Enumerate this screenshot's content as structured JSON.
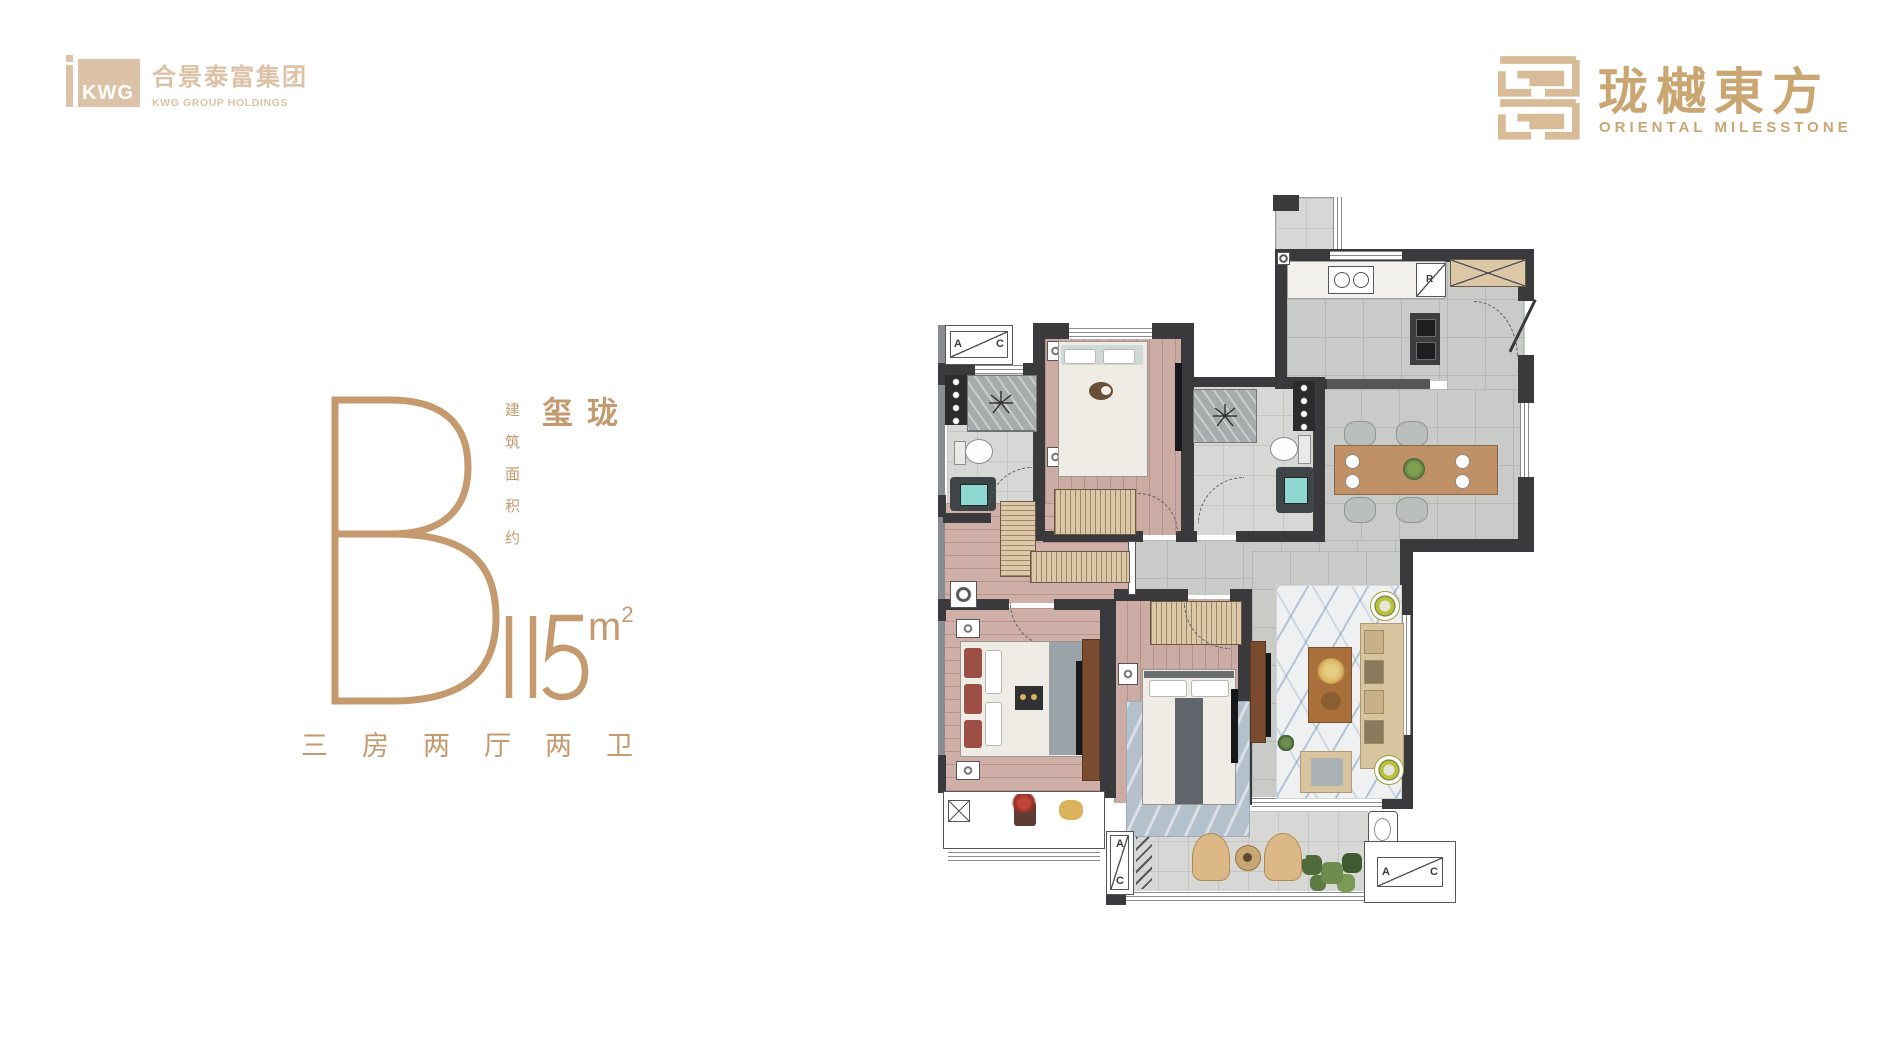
{
  "brand": {
    "kwg": {
      "mark": "KWG",
      "name_cn": "合景泰富集团",
      "name_en": "KWG GROUP HOLDINGS"
    },
    "project": {
      "name_cn": "珑樾東方",
      "name_en": "ORIENTAL MILESSTONE"
    }
  },
  "unit": {
    "type_letter": "B",
    "area_prefix_vertical": "建筑面积约",
    "name_vertical": "珑玺",
    "area_value": "115",
    "area_unit": "m",
    "area_exponent": "2",
    "layout_spec": "三房两厅两卫"
  },
  "floorplan": {
    "ac_label_a": "A",
    "ac_label_c": "C",
    "fridge_label": "R"
  },
  "colors": {
    "accent_gold": "#c49a6e",
    "logo_tan": "#dcc2a6",
    "project_gold": "#c9a672",
    "wall_dark": "#3a3a3c",
    "wood_floor": "#cbaba3",
    "tile_gray": "#c9cbc9"
  }
}
